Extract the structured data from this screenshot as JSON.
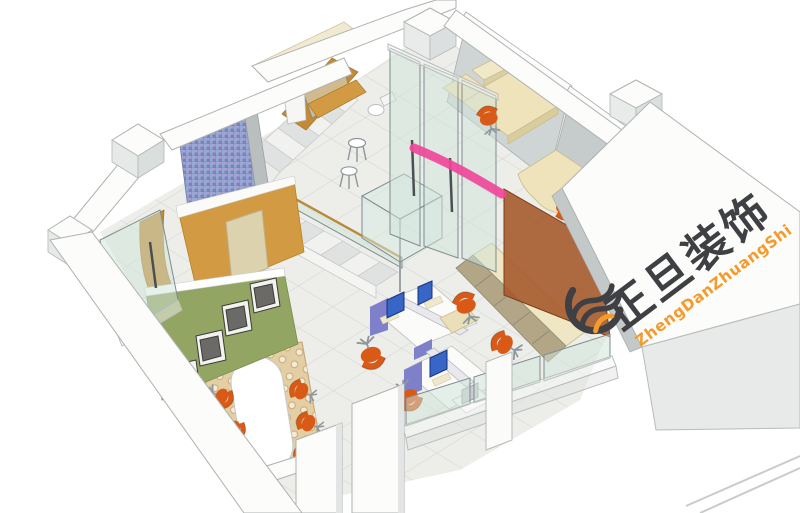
{
  "scene": {
    "type": "3d-interior-rendering",
    "subject": "isometric cutaway view of an office floor plan with staircase, meeting lounge, open workstations, glass partitions and private offices"
  },
  "watermark": {
    "company_name_cn": "正旦装饰",
    "company_name_pinyin": "ZhengDanZhuangShi",
    "icon": "swirl-wave-logo-icon"
  },
  "annotation": {
    "type": "pink-marker-stroke",
    "color": "#ef479a"
  },
  "colors": {
    "arrow_pink": "#ef479a",
    "chair_orange": "#d85a16",
    "wall_ochre": "#d29a43",
    "wall_ochre_dark": "#c28a35",
    "wall_green": "#92a562",
    "mosaic_blue": "#8a96c8",
    "partition_brown": "#a55a2c",
    "rug_beige": "#e4cfa5",
    "monitor_blue": "#3766c6",
    "desk_panel_purple": "#7e81c9",
    "desk_cream": "#eee3ba",
    "cabinet_tan": "#b2a686",
    "glass_green": "#cfe3da",
    "logo_dark": "#3f4043",
    "logo_orange": "#f49b2b",
    "floor_gray": "#edeeea"
  }
}
